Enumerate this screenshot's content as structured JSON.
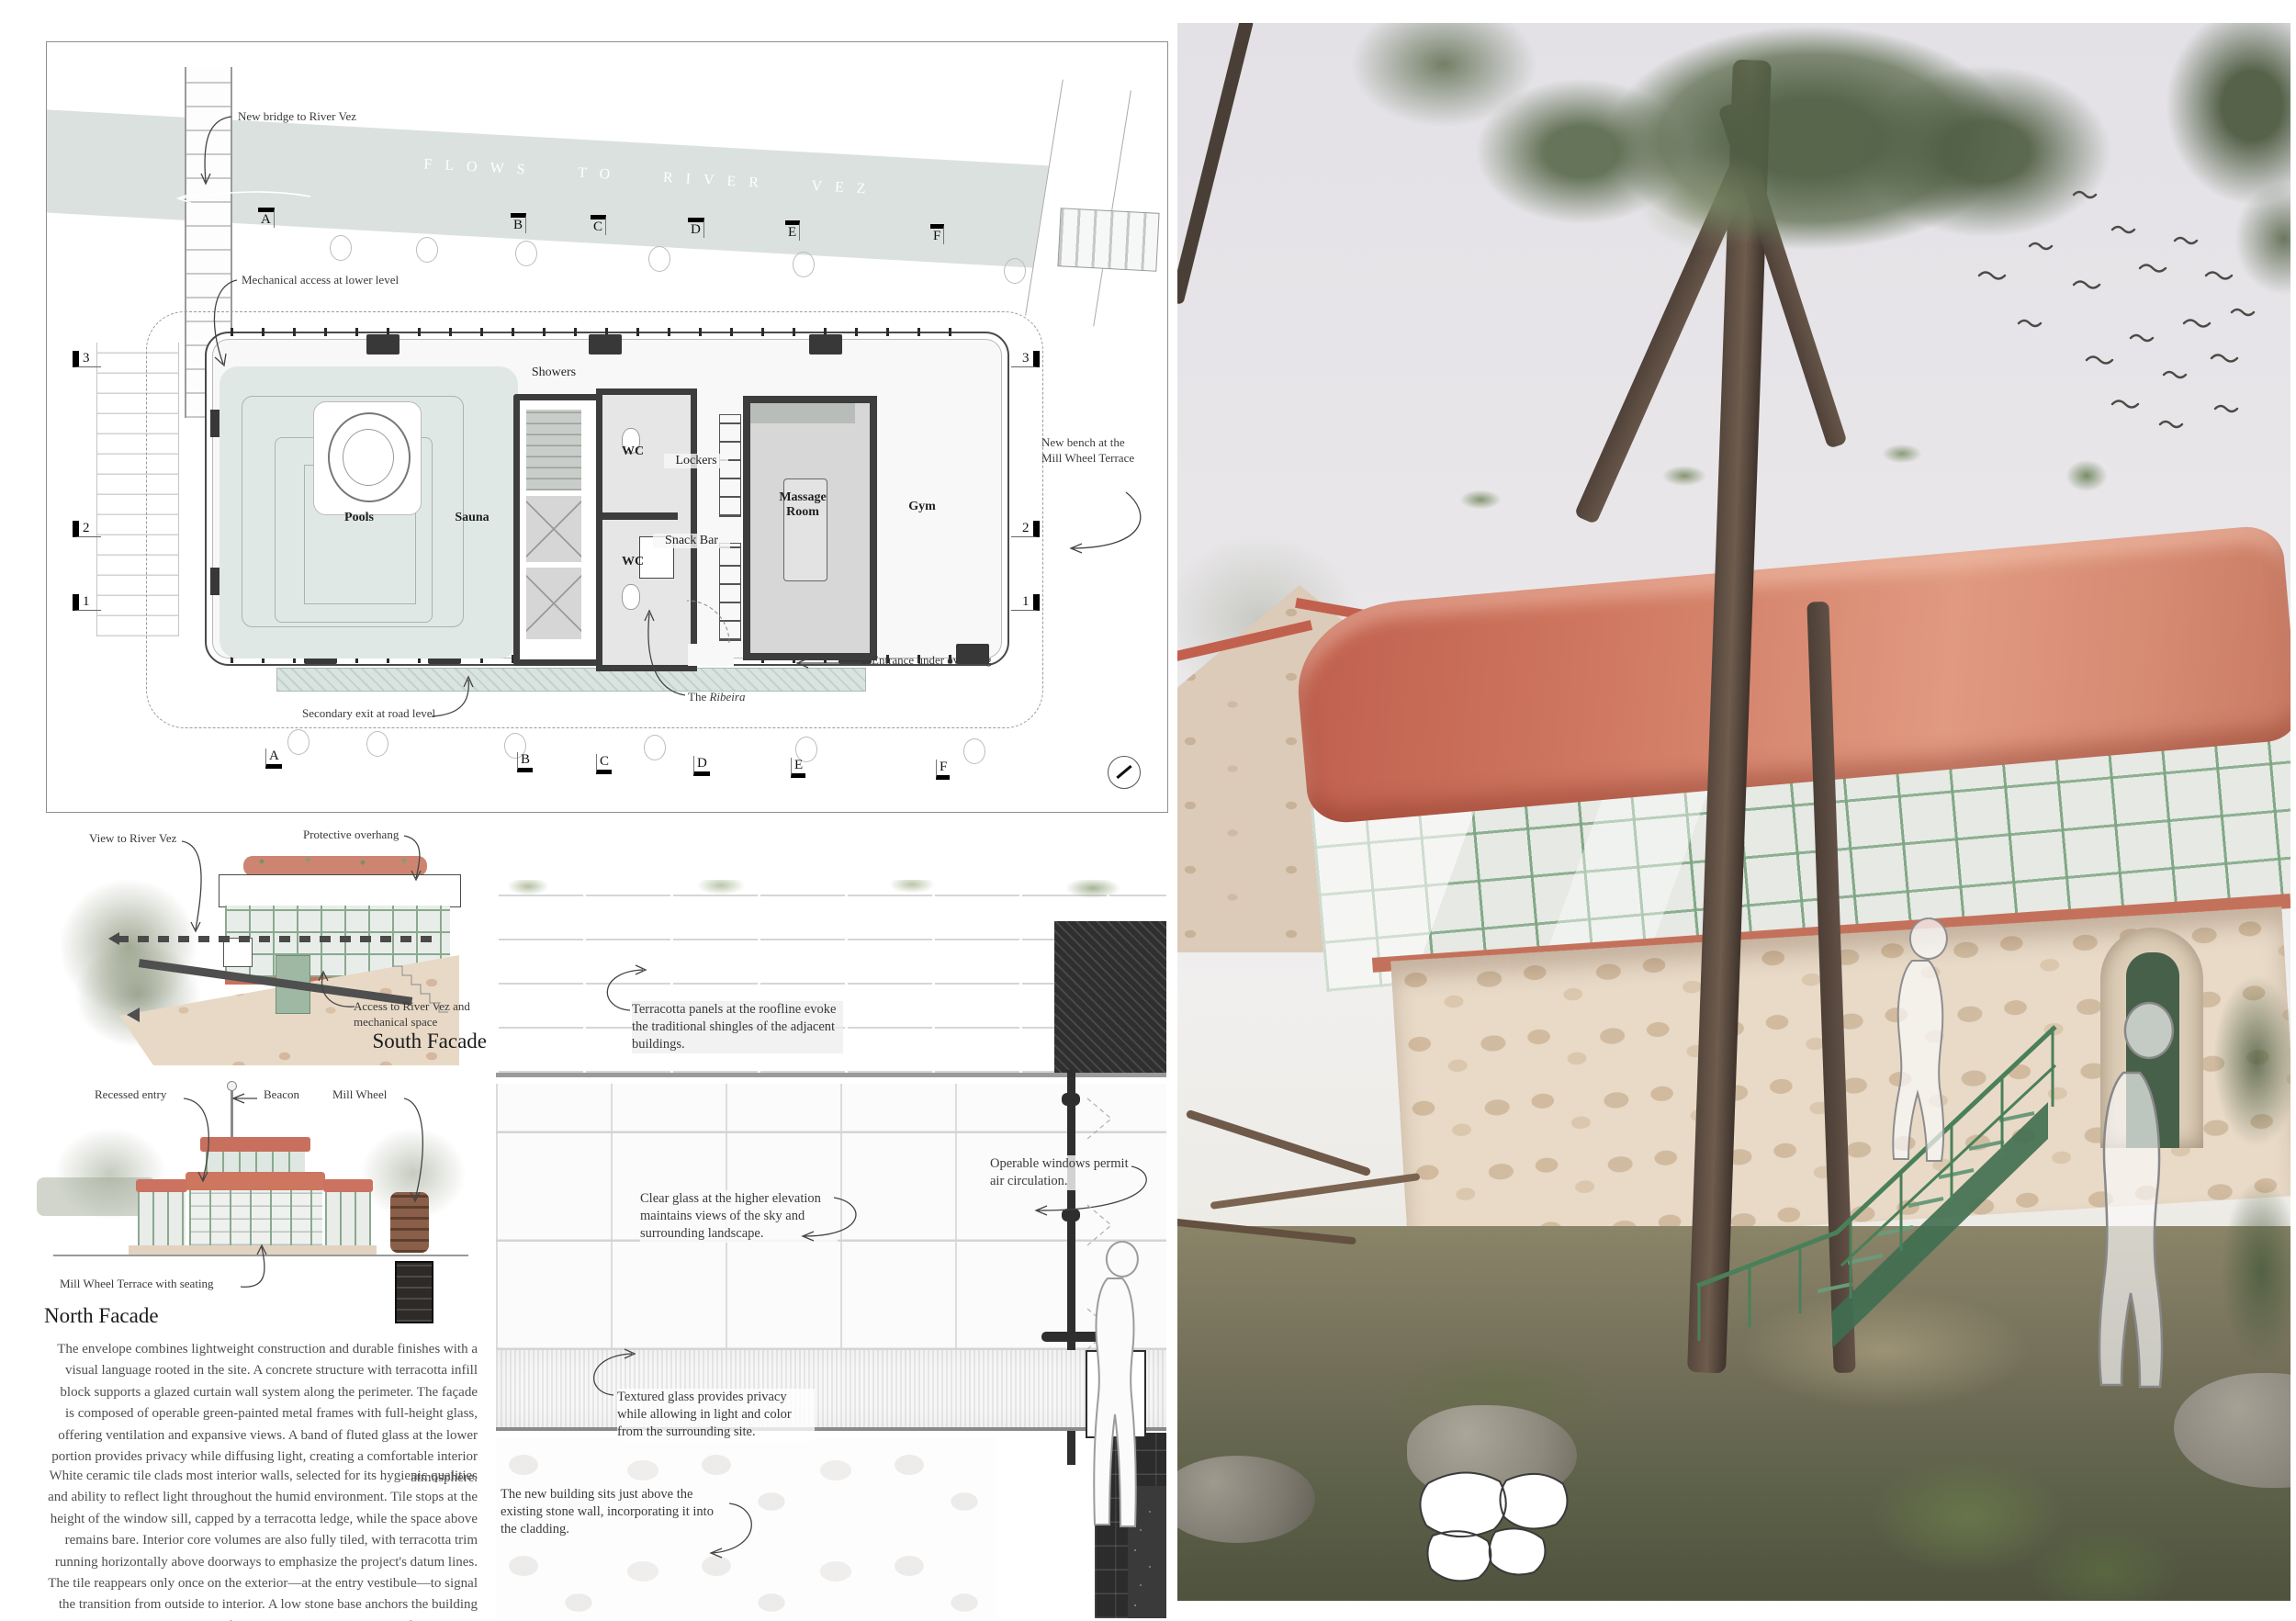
{
  "plan": {
    "river_flow_label": "FLOWS TO RIVER VEZ",
    "grid_letters": [
      "A",
      "B",
      "C",
      "D",
      "E",
      "F"
    ],
    "grid_numbers": [
      "3",
      "2",
      "1"
    ],
    "rooms": {
      "pools": "Pools",
      "sauna": "Sauna",
      "showers": "Showers",
      "wc_upper": "WC",
      "wc_lower": "WC",
      "lockers": "Lockers",
      "snack_bar": "Snack Bar",
      "massage_room": "Massage Room",
      "gym": "Gym"
    },
    "callouts": {
      "new_bridge": "New bridge to River Vez",
      "mechanical_access": "Mechanical access at lower level",
      "new_bench": "New bench at the Mill Wheel Terrace",
      "entrance": "Entrance under overhang",
      "ribeira_prefix": "The ",
      "ribeira_name": "Ribeira",
      "secondary_exit": "Secondary exit at road level"
    }
  },
  "south_facade": {
    "title": "South Facade",
    "callouts": {
      "view": "View to River Vez",
      "overhang": "Protective overhang",
      "access": "Access to River Vez and mechanical space"
    }
  },
  "north_facade": {
    "title": "North Facade",
    "callouts": {
      "recessed_entry": "Recessed entry",
      "beacon": "Beacon",
      "mill_wheel": "Mill Wheel",
      "terrace": "Mill Wheel Terrace with seating"
    }
  },
  "description": {
    "paragraph_1": "The envelope combines lightweight construction and durable finishes with a visual language rooted in the site. A concrete structure with terracotta infill block supports a glazed curtain wall system along the perimeter. The façade is composed of operable green-painted metal frames with full-height glass, offering ventilation and expansive views. A band of fluted glass at the lower portion provides privacy while diffusing light, creating a comfortable interior atmosphere.",
    "paragraph_2": "White ceramic tile clads most interior walls, selected for its hygienic qualities and ability to reflect light throughout the humid environment. Tile stops at the height of the window sill, capped by a terracotta ledge, while the space above remains bare. Interior core volumes are also fully tiled, with terracotta trim running horizontally above doorways to emphasize the project's datum lines. The tile reappears only once on the exterior—at the entry vestibule—to signal the transition from outside to interior. A low stone base anchors the building to the historic stone walls of the site. Above, the planted roof extends the garden, while a luminous beacon held by a vertical green-painted metal post marks the entrance and terminates the primary horizontals, serving as a subtle landmark on the grounds."
  },
  "wall_section": {
    "callouts": {
      "terracotta_panels": "Terracotta panels at the roofline evoke the traditional shingles of the adjacent buildings.",
      "clear_glass": "Clear glass at the higher elevation maintains views of the sky and surrounding landscape.",
      "operable_windows": "Operable windows permit air circulation.",
      "textured_glass": "Textured glass provides privacy while allowing in light and color from the surrounding site.",
      "stone_wall": "The new building sits just above the existing stone wall, incorporating it into the cladding."
    }
  },
  "colors": {
    "terracotta": "#c97a62",
    "frame_green": "#7fa383",
    "stair_green": "#47795a",
    "river": "#dbe1de",
    "stone": "#e8dac7",
    "sky": "#e3e1e6"
  }
}
